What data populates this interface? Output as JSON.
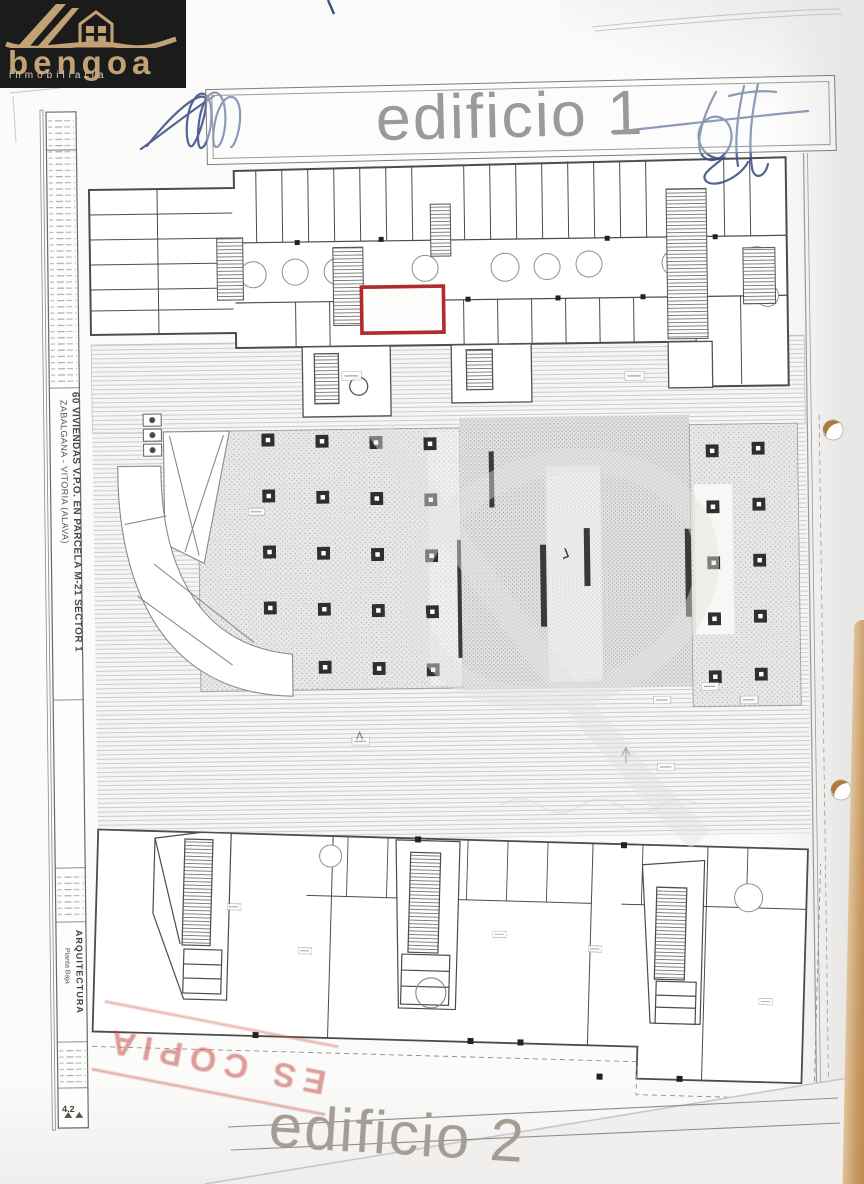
{
  "logo": {
    "brand": "bengoa",
    "tagline": "inmobiliaria",
    "bg_color": "#1b1b1b",
    "gold_color": "#c2a274"
  },
  "banner": {
    "title": "edificio 1"
  },
  "next_sheet": {
    "title": "edificio 2"
  },
  "titleblock": {
    "project_line1": "60 VIVIENDAS V.P.O. EN PARCELA M-21 SECTOR 1",
    "project_line2": "ZABALGANA - VITORIA (ALAVA)",
    "discipline": "ARQUITECTURA",
    "plan_name": "Planta Baja",
    "sheet_number": "4.2"
  },
  "stamp": {
    "text": "ES COPIA",
    "color": "#c25550"
  },
  "plan": {
    "highlight_room_color": "#b02b2b",
    "title_gray": "#9a9a9a",
    "signature_blue": "#3a4f86",
    "binder_hole_tan": "#b07a3e"
  }
}
